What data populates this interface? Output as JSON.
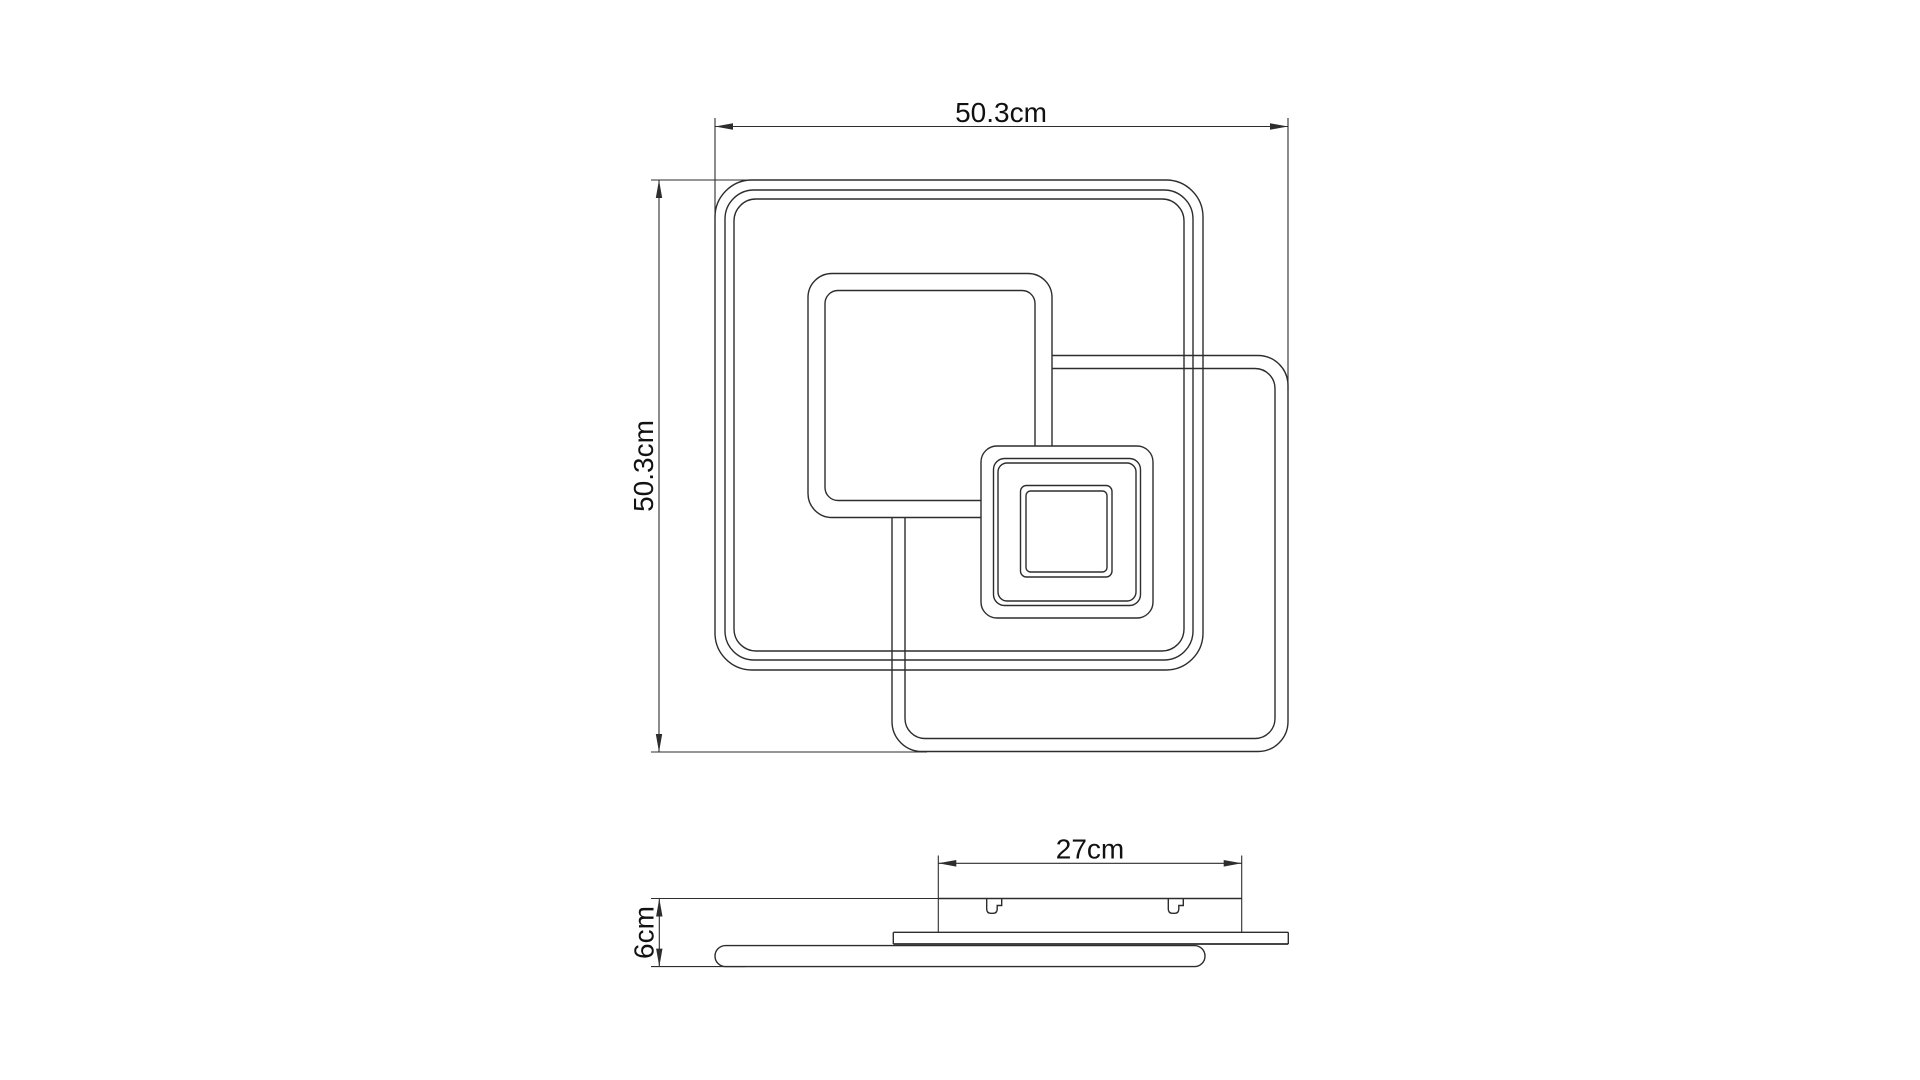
{
  "drawing": {
    "description": "Technical dimensional drawing of a square LED ceiling light, top view and side profile view",
    "line_color": "#2d2d2d",
    "text_color": "#111111",
    "background": "#ffffff",
    "top_view": {
      "width_label": "50.3cm",
      "width_value_cm": 50.3,
      "height_label": "50.3cm",
      "height_value_cm": 50.3
    },
    "side_view": {
      "mount_width_label": "27cm",
      "mount_width_value_cm": 27,
      "height_label": "6cm",
      "height_value_cm": 6
    }
  }
}
